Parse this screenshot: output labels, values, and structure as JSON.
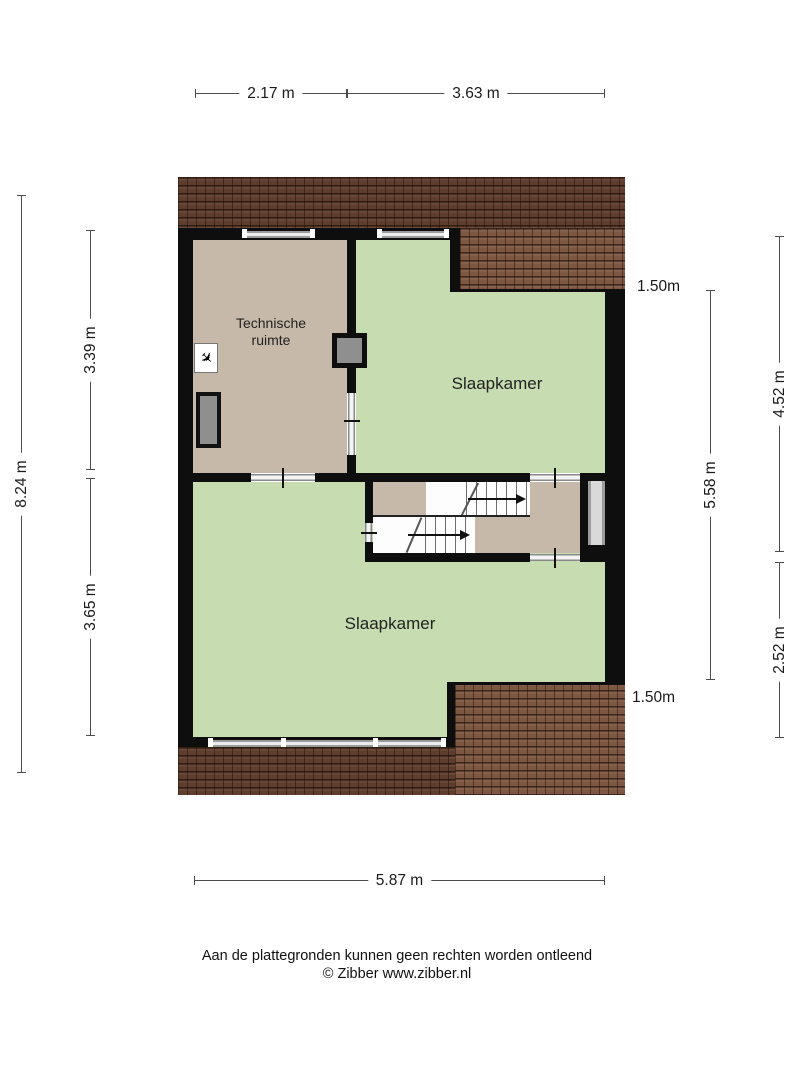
{
  "colors": {
    "bg": "#ffffff",
    "wall": "#0e0e0e",
    "green": "#c8dcb2",
    "tan": "#c7b9a9",
    "roof_dark": "#5e3d2c",
    "roof_light": "#7d5743",
    "win": "#9c9c9c",
    "fixture": "#8f8f8f",
    "dim": "#4d4d4d",
    "ink": "#1a1a1a"
  },
  "rooms": {
    "technische_ruimte": {
      "label_line1": "Technische",
      "label_line2": "ruimte"
    },
    "slaapkamer_top": {
      "label": "Slaapkamer"
    },
    "slaapkamer_bottom": {
      "label": "Slaapkamer"
    }
  },
  "dimensions": {
    "top": [
      {
        "label": "2.17 m"
      },
      {
        "label": "3.63 m"
      }
    ],
    "bottom": [
      {
        "label": "5.87 m"
      }
    ],
    "left_outer": {
      "label": "8.24 m"
    },
    "left_inner": [
      {
        "label": "3.39 m"
      },
      {
        "label": "3.65 m"
      }
    ],
    "right_inner": {
      "label": "5.58 m"
    },
    "right_outer": [
      {
        "label": "4.52 m"
      },
      {
        "label": "2.52 m"
      }
    ],
    "headroom_top": {
      "label": "1.50m"
    },
    "headroom_bottom": {
      "label": "1.50m"
    }
  },
  "icons": {
    "mv_unit": "✈"
  },
  "footer": {
    "disclaimer": "Aan de plattegronden kunnen geen rechten worden ontleend",
    "copyright": "© Zibber www.zibber.nl"
  }
}
